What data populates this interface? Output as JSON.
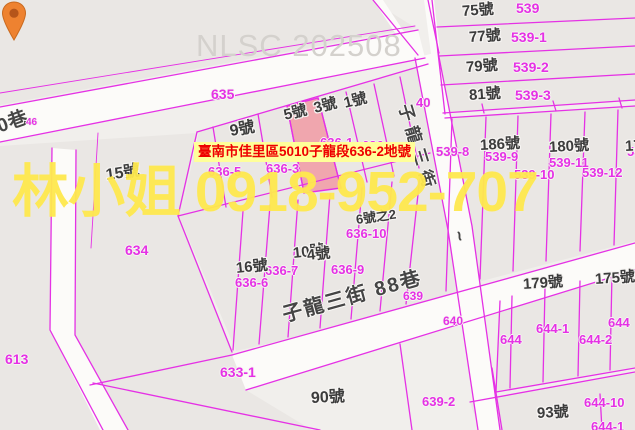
{
  "watermarks": {
    "nlsc": "NLSC 202508",
    "agent": "林小姐 0918-952-707"
  },
  "tooltip": {
    "text": "臺南市佳里區5010子龍段636-2地號"
  },
  "colors": {
    "accent": "#e531e5",
    "highlight-parcel": "#f0a6ae",
    "tooltip-bg": "#ffff99",
    "tooltip-text": "#ee0000",
    "watermark-yellow": "#ffe94e",
    "nlsc-gray": "#d4d1cd"
  },
  "map": {
    "marker": {
      "name": "location-pin",
      "parcel": "636-2"
    },
    "street_labels": [
      {
        "text": "子龍三街",
        "x": 404,
        "y": 96,
        "fs": 17,
        "rot": 73,
        "ls": 6
      },
      {
        "text": "~",
        "x": 458,
        "y": 222,
        "fs": 18,
        "rot": 73,
        "ls": 0
      },
      {
        "text": "子龍三街 88巷",
        "x": 283,
        "y": 306,
        "fs": 20,
        "rot": -15.5,
        "ls": 2
      },
      {
        "text": "0巷",
        "x": -2,
        "y": 118,
        "fs": 19,
        "rot": -20,
        "ls": 0
      }
    ],
    "house_labels": [
      {
        "text": "15號",
        "x": 106,
        "y": 168,
        "fs": 16,
        "rot": -8
      },
      {
        "text": "9號",
        "x": 230,
        "y": 124,
        "fs": 16,
        "rot": -10
      },
      {
        "text": "5號",
        "x": 284,
        "y": 108,
        "fs": 15,
        "rot": -14
      },
      {
        "text": "3號",
        "x": 314,
        "y": 101,
        "fs": 15,
        "rot": -14
      },
      {
        "text": "1號",
        "x": 344,
        "y": 96,
        "fs": 15,
        "rot": -14
      },
      {
        "text": "75號",
        "x": 462,
        "y": 4,
        "fs": 15,
        "rot": -4
      },
      {
        "text": "77號",
        "x": 469,
        "y": 30,
        "fs": 15,
        "rot": -4
      },
      {
        "text": "79號",
        "x": 466,
        "y": 60,
        "fs": 15,
        "rot": -4
      },
      {
        "text": "81號",
        "x": 469,
        "y": 88,
        "fs": 15,
        "rot": -4
      },
      {
        "text": "186號",
        "x": 480,
        "y": 138,
        "fs": 15,
        "rot": -3
      },
      {
        "text": "180號",
        "x": 549,
        "y": 140,
        "fs": 15,
        "rot": -3
      },
      {
        "text": "17",
        "x": 625,
        "y": 139,
        "fs": 15,
        "rot": -3
      },
      {
        "text": "16號",
        "x": 236,
        "y": 261,
        "fs": 15,
        "rot": -6
      },
      {
        "text": "10號",
        "x": 293,
        "y": 246,
        "fs": 15,
        "rot": -6
      },
      {
        "text": "4號",
        "x": 307,
        "y": 248,
        "fs": 15,
        "rot": -6
      },
      {
        "text": "6號之2",
        "x": 356,
        "y": 213,
        "fs": 13,
        "rot": -8
      },
      {
        "text": "179號",
        "x": 523,
        "y": 277,
        "fs": 15,
        "rot": -4
      },
      {
        "text": "175號",
        "x": 595,
        "y": 272,
        "fs": 15,
        "rot": -4
      },
      {
        "text": "90號",
        "x": 311,
        "y": 391,
        "fs": 16,
        "rot": -3
      },
      {
        "text": "93號",
        "x": 537,
        "y": 406,
        "fs": 15,
        "rot": -3
      }
    ],
    "parcel_labels": [
      {
        "text": "46",
        "x": 26,
        "y": 118,
        "fs": 10
      },
      {
        "text": "635",
        "x": 211,
        "y": 87,
        "fs": 14
      },
      {
        "text": "539",
        "x": 516,
        "y": 1,
        "fs": 14
      },
      {
        "text": "539-1",
        "x": 511,
        "y": 30,
        "fs": 14
      },
      {
        "text": "539-2",
        "x": 513,
        "y": 60,
        "fs": 14
      },
      {
        "text": "539-3",
        "x": 515,
        "y": 88,
        "fs": 14
      },
      {
        "text": "40",
        "x": 416,
        "y": 96,
        "fs": 13
      },
      {
        "text": "636-1",
        "x": 320,
        "y": 136,
        "fs": 13
      },
      {
        "text": "636",
        "x": 362,
        "y": 139,
        "fs": 13
      },
      {
        "text": "539-8",
        "x": 436,
        "y": 145,
        "fs": 13
      },
      {
        "text": "539-9",
        "x": 485,
        "y": 150,
        "fs": 13
      },
      {
        "text": "539-11",
        "x": 549,
        "y": 156,
        "fs": 13
      },
      {
        "text": "539-10",
        "x": 514,
        "y": 168,
        "fs": 13
      },
      {
        "text": "539-12",
        "x": 582,
        "y": 166,
        "fs": 13
      },
      {
        "text": "539",
        "x": 627,
        "y": 145,
        "fs": 13
      },
      {
        "text": "636-5",
        "x": 208,
        "y": 165,
        "fs": 13
      },
      {
        "text": "636-3",
        "x": 266,
        "y": 162,
        "fs": 13
      },
      {
        "text": "636-10",
        "x": 346,
        "y": 227,
        "fs": 13
      },
      {
        "text": "636-7",
        "x": 265,
        "y": 264,
        "fs": 13
      },
      {
        "text": "636-9",
        "x": 331,
        "y": 263,
        "fs": 13
      },
      {
        "text": "636-6",
        "x": 235,
        "y": 276,
        "fs": 13
      },
      {
        "text": "639",
        "x": 403,
        "y": 290,
        "fs": 12
      },
      {
        "text": "640",
        "x": 443,
        "y": 315,
        "fs": 12
      },
      {
        "text": "634",
        "x": 125,
        "y": 243,
        "fs": 14
      },
      {
        "text": "613",
        "x": 5,
        "y": 352,
        "fs": 14
      },
      {
        "text": "633-1",
        "x": 220,
        "y": 365,
        "fs": 14
      },
      {
        "text": "639-2",
        "x": 422,
        "y": 395,
        "fs": 13
      },
      {
        "text": "644",
        "x": 500,
        "y": 333,
        "fs": 13
      },
      {
        "text": "644-1",
        "x": 536,
        "y": 322,
        "fs": 13
      },
      {
        "text": "644-2",
        "x": 579,
        "y": 333,
        "fs": 13
      },
      {
        "text": "644",
        "x": 608,
        "y": 316,
        "fs": 13
      },
      {
        "text": "644-10",
        "x": 584,
        "y": 396,
        "fs": 13
      },
      {
        "text": "644-1",
        "x": 591,
        "y": 420,
        "fs": 13
      }
    ]
  }
}
